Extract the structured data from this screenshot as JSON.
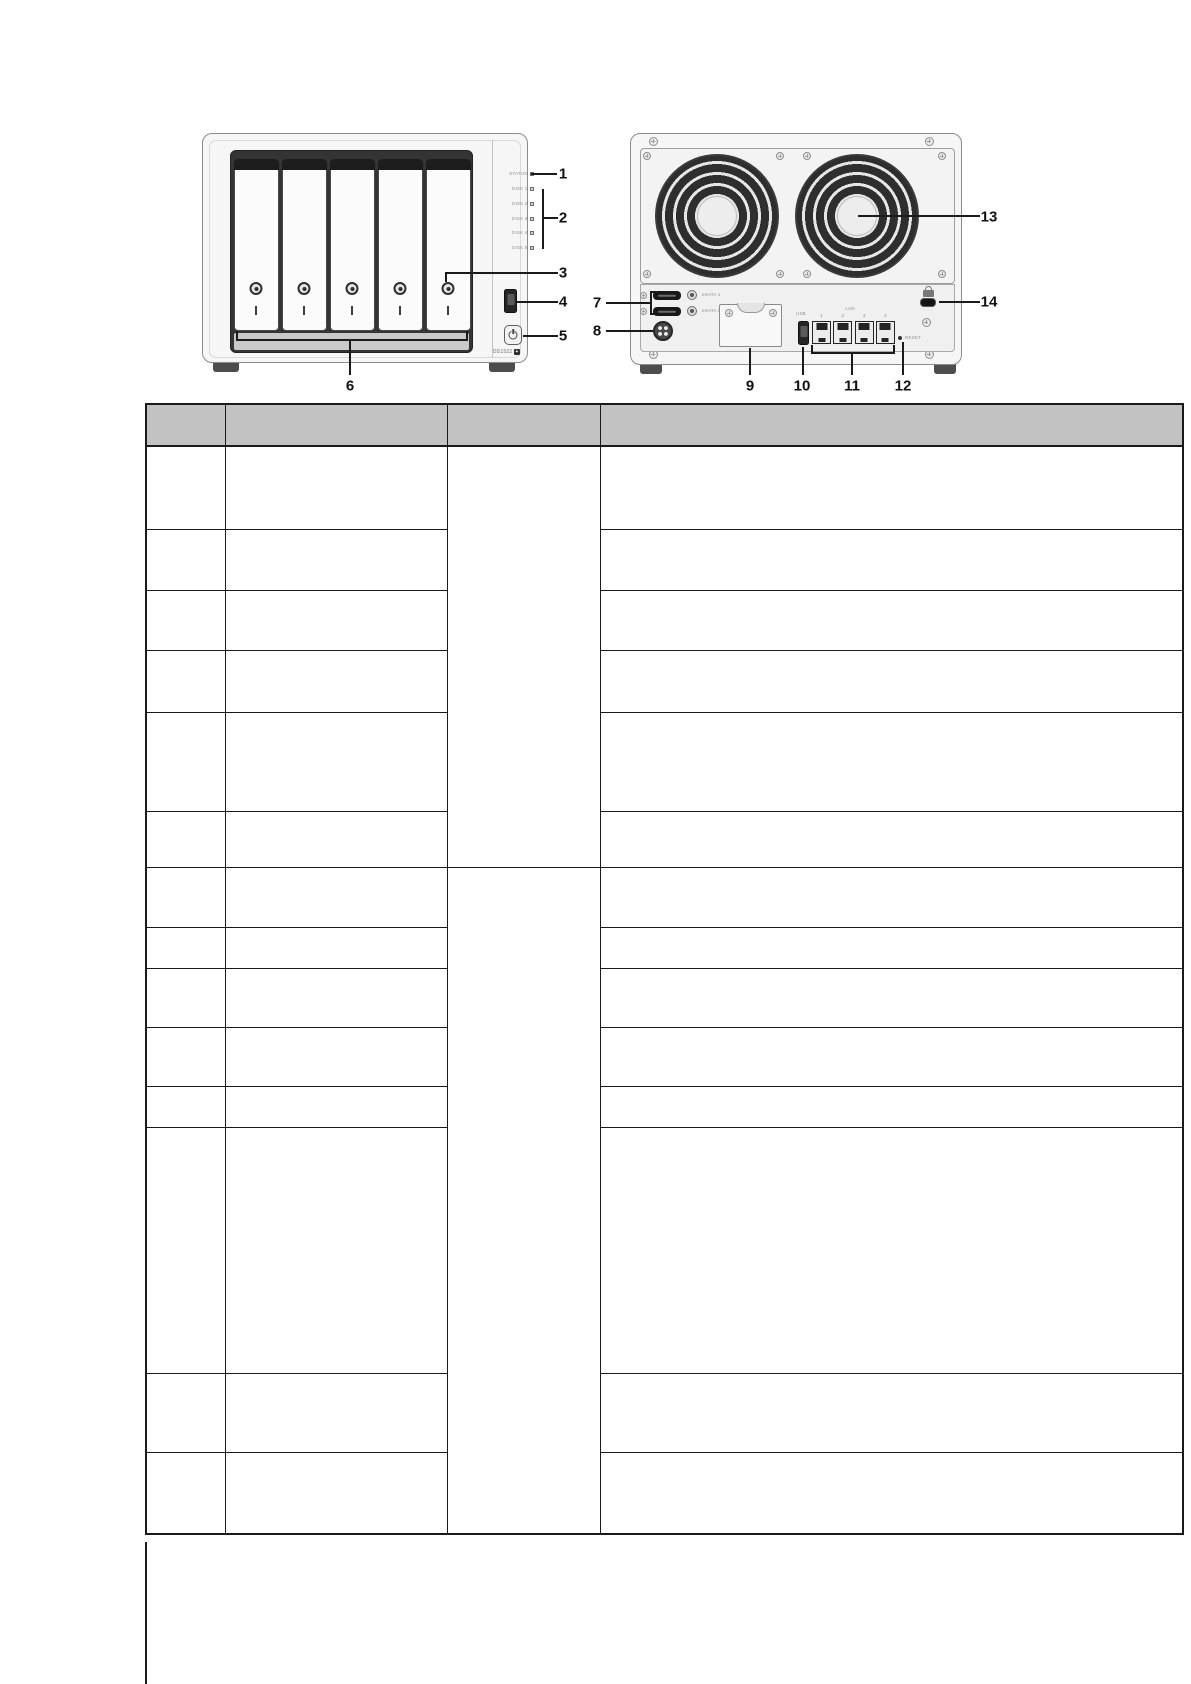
{
  "callouts": {
    "labels": [
      "1",
      "2",
      "3",
      "4",
      "5",
      "6",
      "7",
      "8",
      "9",
      "10",
      "11",
      "12",
      "13",
      "14"
    ]
  },
  "front_panel": {
    "model": "DS1522",
    "model_suffix": "+",
    "led_labels": [
      "STATUS",
      "DISK 1",
      "DISK 2",
      "DISK 3",
      "DISK 4",
      "DISK 5"
    ]
  },
  "back_panel": {
    "esata_port_labels": [
      "eSATA 1",
      "eSATA 2"
    ],
    "usb_label": "USB",
    "lan_group_label": "LAN",
    "lan_port_numbers": [
      "1",
      "2",
      "3",
      "4"
    ],
    "reset_label": "RESET"
  },
  "table": {
    "column_headers": [
      "",
      "",
      "",
      ""
    ],
    "rows": [
      [
        "",
        "",
        "",
        ""
      ],
      [
        "",
        "",
        ""
      ],
      [
        "",
        "",
        ""
      ],
      [
        "",
        "",
        ""
      ],
      [
        "",
        "",
        ""
      ],
      [
        "",
        "",
        ""
      ],
      [
        "",
        "",
        "",
        ""
      ],
      [
        "",
        "",
        ""
      ],
      [
        "",
        "",
        ""
      ],
      [
        "",
        "",
        ""
      ],
      [
        "",
        "",
        ""
      ],
      [
        "",
        "",
        ""
      ],
      [
        "",
        "",
        ""
      ],
      [
        "",
        "",
        ""
      ]
    ]
  },
  "colors": {
    "table_header_bg": "#c2c2c2",
    "table_border": "#1a1a1a",
    "leader_line": "#1a1a1a",
    "chassis_fill": "#f6f6f6"
  }
}
